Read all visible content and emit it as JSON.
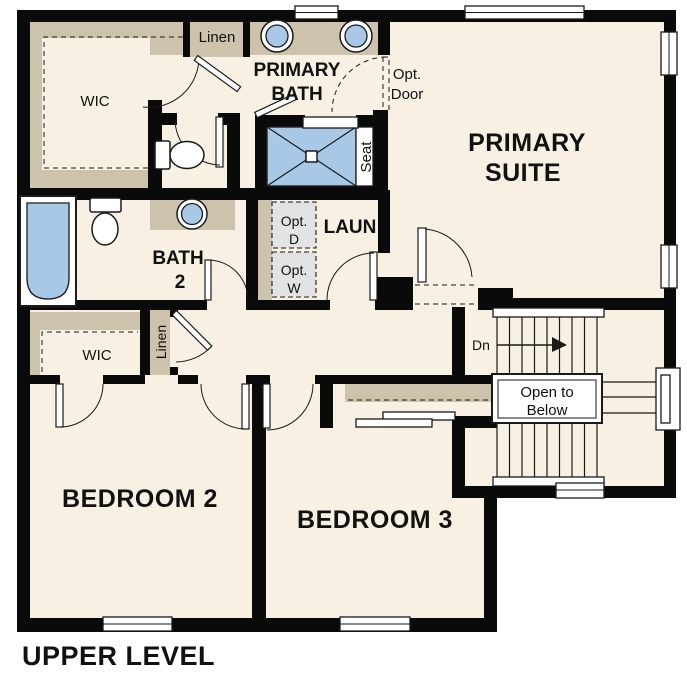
{
  "plan": {
    "title": "UPPER LEVEL",
    "level": "Upper Level floor plan"
  },
  "palette": {
    "background": "#ffffff",
    "floor": "#f7f0e3",
    "wall": "#0a0a0a",
    "casework_tan": "#cdc2ac",
    "fixture_blue": "#a9c8e7",
    "optional_gray": "#e3e3e3",
    "line": "#1a1a1a"
  },
  "rooms": {
    "primary_suite": {
      "line1": "PRIMARY",
      "line2": "SUITE"
    },
    "primary_bath": {
      "line1": "PRIMARY",
      "line2": "BATH"
    },
    "bath2": {
      "line1": "BATH",
      "line2": "2"
    },
    "laundry": {
      "label": "LAUN"
    },
    "bedroom2": {
      "label": "BEDROOM 2"
    },
    "bedroom3": {
      "label": "BEDROOM 3"
    },
    "wic_primary": {
      "label": "WIC"
    },
    "wic_bedroom2": {
      "label": "WIC"
    },
    "linen_bath": {
      "label": "Linen"
    },
    "linen_hall": {
      "label": "Linen"
    }
  },
  "annotations": {
    "opt_door": {
      "line1": "Opt.",
      "line2": "Door"
    },
    "opt_dryer": {
      "line1": "Opt.",
      "line2": "D"
    },
    "opt_washer": {
      "line1": "Opt.",
      "line2": "W"
    },
    "seat": {
      "label": "Seat"
    },
    "stairs_down": {
      "label": "Dn"
    },
    "open_to_below": {
      "line1": "Open to",
      "line2": "Below"
    }
  }
}
